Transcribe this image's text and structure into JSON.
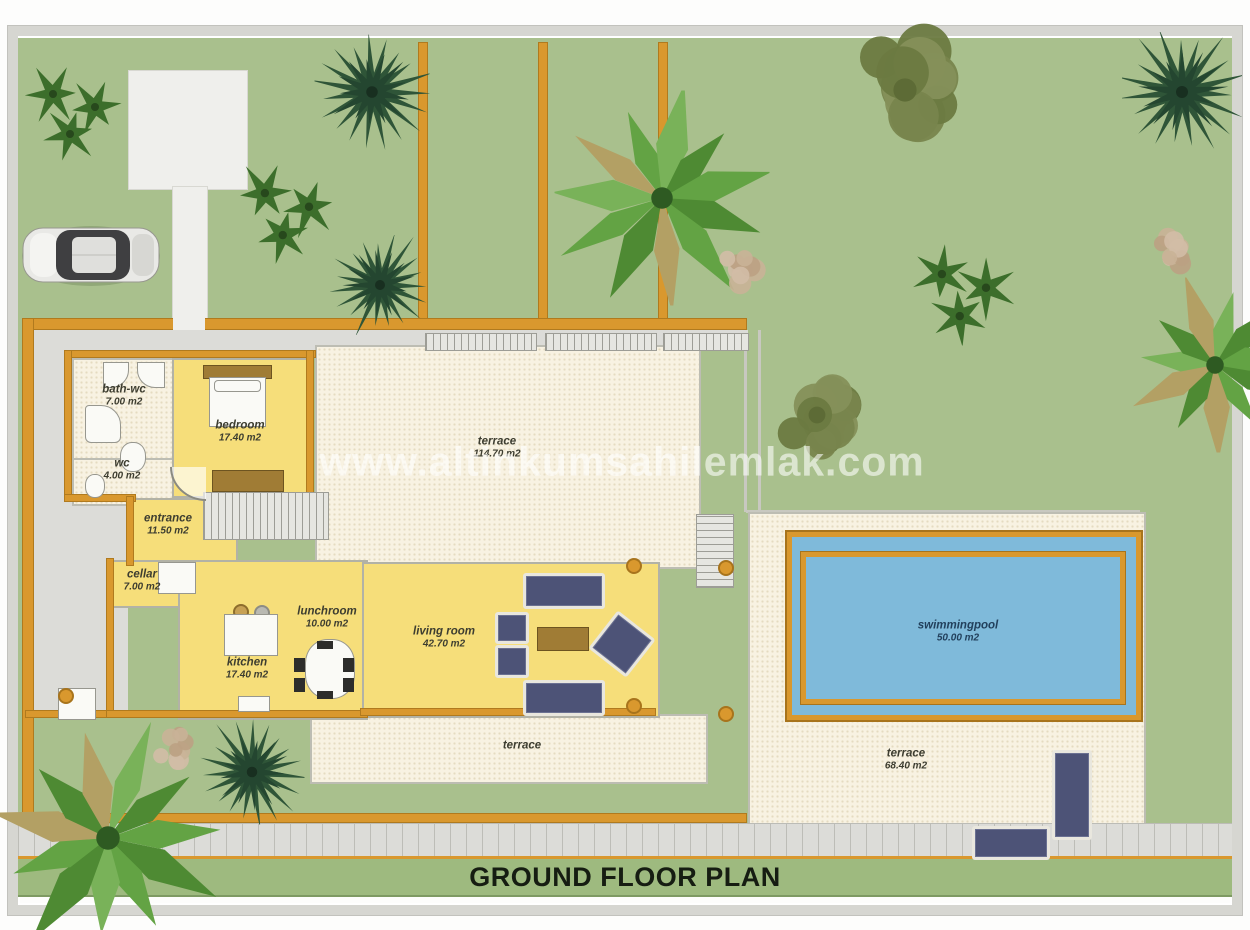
{
  "title": "GROUND FLOOR PLAN",
  "watermark": "www.altinkumsahilemlak.com",
  "labels": {
    "bathwc": {
      "name": "bath-wc",
      "area": "7.00 m2"
    },
    "wc": {
      "name": "wc",
      "area": "4.00 m2"
    },
    "bedroom": {
      "name": "bedroom",
      "area": "17.40 m2"
    },
    "terrace_main": {
      "name": "terrace",
      "area": "114.70 m2"
    },
    "entrance": {
      "name": "entrance",
      "area": "11.50 m2"
    },
    "cellar": {
      "name": "cellar",
      "area": "7.00 m2"
    },
    "lunchroom": {
      "name": "lunchroom",
      "area": "10.00 m2"
    },
    "kitchen": {
      "name": "kitchen",
      "area": "17.40 m2"
    },
    "living": {
      "name": "living room",
      "area": "42.70 m2"
    },
    "pool": {
      "name": "swimmingpool",
      "area": "50.00 m2"
    },
    "terrace_pool": {
      "name": "terrace",
      "area": "68.40 m2"
    },
    "terrace_bottom": {
      "name": "terrace",
      "area": ""
    }
  },
  "colors": {
    "grass": "#a9c08d",
    "wall": "#d9982e",
    "yellow": "#f6de7a",
    "cream": "#f8f2e2",
    "creamdot": "#e5dbc1",
    "pool": "#7fbada",
    "gray": "#dcdcd8",
    "frame": "#d6d6d1",
    "titlebar": "#9eba7f",
    "sofa": "#4d5377",
    "wood": "#a07c35"
  },
  "landscape": {
    "trees": [
      {
        "type": "bush",
        "x": 57,
        "y": 74,
        "s": 100
      },
      {
        "type": "bush",
        "x": 270,
        "y": 174,
        "s": 105
      },
      {
        "type": "conifer",
        "x": 354,
        "y": 54,
        "s": 115
      },
      {
        "type": "conifer",
        "x": 362,
        "y": 247,
        "s": 100
      },
      {
        "type": "palm",
        "x": 644,
        "y": 160,
        "s": 215
      },
      {
        "type": "gravel",
        "x": 719,
        "y": 234,
        "s": 60
      },
      {
        "type": "olive",
        "x": 887,
        "y": 52,
        "s": 145
      },
      {
        "type": "conifer",
        "x": 1164,
        "y": 54,
        "s": 120
      },
      {
        "type": "bush",
        "x": 947,
        "y": 255,
        "s": 105
      },
      {
        "type": "gravel",
        "x": 1150,
        "y": 214,
        "s": 58
      },
      {
        "type": "palm",
        "x": 1197,
        "y": 327,
        "s": 175
      },
      {
        "type": "olive",
        "x": 799,
        "y": 377,
        "s": 105
      },
      {
        "type": "conifer",
        "x": 234,
        "y": 734,
        "s": 105
      },
      {
        "type": "gravel",
        "x": 154,
        "y": 709,
        "s": 55
      },
      {
        "type": "palm",
        "x": 90,
        "y": 800,
        "s": 235
      }
    ],
    "columns": [
      {
        "x": 616,
        "y": 528
      },
      {
        "x": 616,
        "y": 668
      },
      {
        "x": 708,
        "y": 530
      },
      {
        "x": 708,
        "y": 676
      },
      {
        "x": 48,
        "y": 658
      }
    ]
  }
}
